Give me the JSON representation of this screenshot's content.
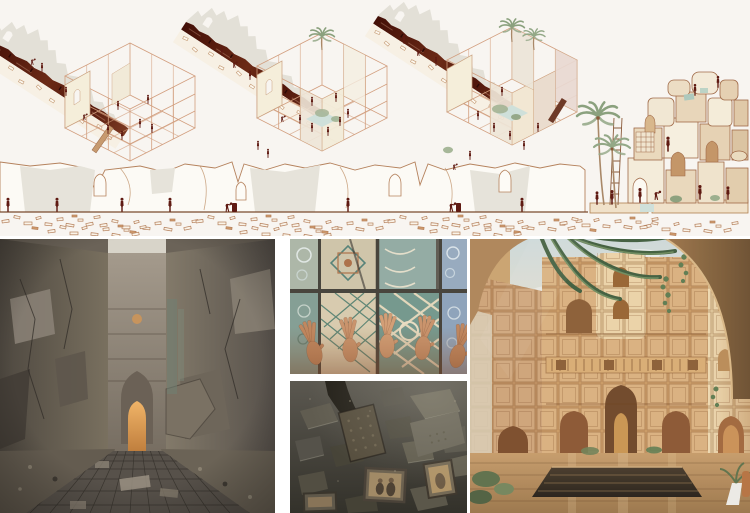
{
  "window": {
    "title": "Architecture presentation board",
    "width": 750,
    "height": 513,
    "background": "#ffffff"
  },
  "board": {
    "top_drawings": {
      "background": "#f8f5f1",
      "ink_color": "#b5825d",
      "wireframe_color": "#d29e7e",
      "figure_color": "#5f1a12",
      "ruin_band_color": "#54170d",
      "silhouette_color": "#e3e0d7",
      "pool_color": "#cfe0da",
      "foliage_color": "#8ba17e",
      "panels": [
        {
          "id": "axonometric-stage-1",
          "label": "Scaffold wireframe raised beside the ruined wall, workers inside"
        },
        {
          "id": "axonometric-stage-2",
          "label": "Scaffolded courtyard with pool, palm and many workers"
        },
        {
          "id": "axonometric-stage-3",
          "label": "Infilled volume with rooftop palms, plants and pool"
        },
        {
          "id": "ruin-elevation",
          "label": "Long ruined wall elevation with arched openings, workers and rubble field"
        },
        {
          "id": "fragment-tower",
          "label": "Stacked stone-fragment facade with palms, ladder and climbing figures"
        }
      ]
    },
    "photos": [
      {
        "id": "corridor-photo",
        "label": "Ruined corridor with damaged walls, mesh floor and glowing pointed arch",
        "dominant": "#6b6358",
        "accent": "#d79a4e"
      },
      {
        "id": "tile-hands-photo",
        "label": "Hands reaching up to touch patterned glazed tilework",
        "dominant": "#9fb5a8",
        "accent": "#c78f66"
      },
      {
        "id": "rubble-photo",
        "label": "Hand salvaging framed photographs from grey rubble",
        "dominant": "#4a4840",
        "accent": "#a18a66"
      },
      {
        "id": "courtyard-render",
        "label": "Warm courtyard of stacked ornamental facades with reflecting pool and palms",
        "dominant": "#c9955c",
        "accent": "#3a2f22"
      }
    ]
  }
}
